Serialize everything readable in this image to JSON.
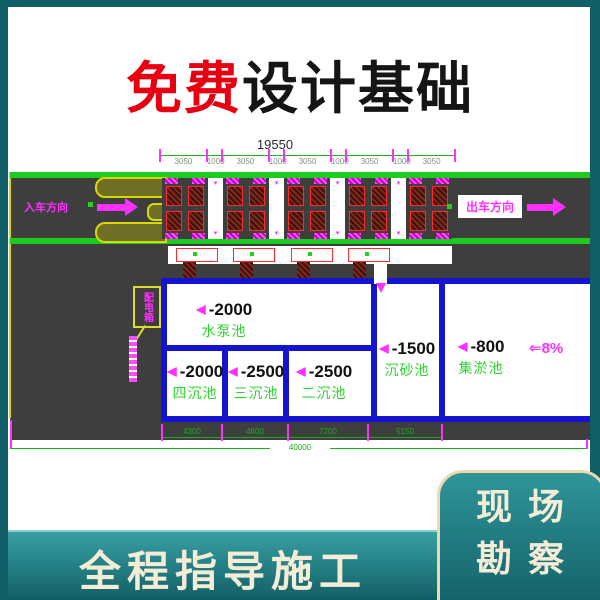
{
  "title": {
    "highlight": "免费",
    "rest": "设计基础"
  },
  "colors": {
    "accent_red": "#e60012",
    "frame_teal": "#0f5e68",
    "banner_teal": "#26858a",
    "cream": "#f5ecd6",
    "cad_green": "#1fca1f",
    "cad_magenta": "#ff2fff",
    "cad_blue": "#1414cf"
  },
  "drawing": {
    "dims_top": {
      "total": "19550",
      "segments": [
        "3050",
        "1000",
        "3050",
        "1000",
        "3050",
        "1000",
        "3050",
        "1000",
        "3050"
      ]
    },
    "entry_label": "入车方向",
    "exit_label": "出车方向",
    "annotation_label": "配电箱",
    "pools": [
      {
        "level": "-2000",
        "name": "水泵池"
      },
      {
        "level": "-2000",
        "name": "四沉池"
      },
      {
        "level": "-2500",
        "name": "三沉池"
      },
      {
        "level": "-2500",
        "name": "二沉池"
      },
      {
        "level": "-1500",
        "name": "沉砂池"
      },
      {
        "level": "-800",
        "name": "集淤池"
      }
    ],
    "slope_label": "⇐8%",
    "dims_bottom": {
      "segments": [
        "4300",
        "4600",
        "7200",
        "5150"
      ],
      "total": "40000"
    }
  },
  "footer": {
    "banner_label": "全程指导施工",
    "badge_line1": "现场",
    "badge_line2": "勘察"
  }
}
